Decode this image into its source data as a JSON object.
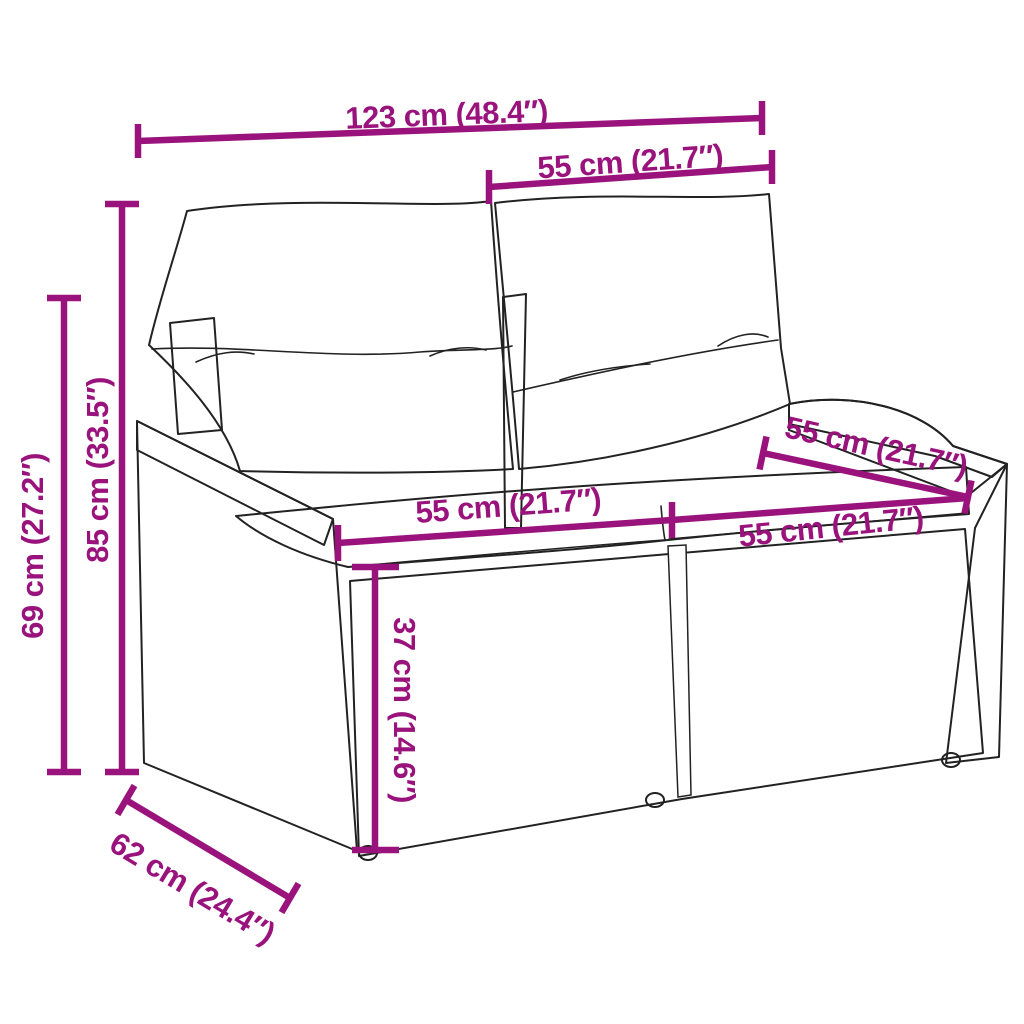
{
  "diagram": {
    "type": "product-dimension-diagram",
    "subject": "poly-rattan 2-seater garden sofa with back and seat cushions",
    "accent_color": "#9a137c",
    "line_art_color": "#222222",
    "background_color": "#ffffff",
    "dimensions": {
      "total_width": "123 cm (48.4″)",
      "backrest_width": "55 cm (21.7″)",
      "total_height": "85 cm (33.5″)",
      "armrest_height": "69 cm (27.2″)",
      "seat_depth": "55 cm (21.7″)",
      "seat_width_left": "55 cm (21.7″)",
      "seat_width_right": "55 cm (21.7″)",
      "seat_height": "37 cm (14.6″)",
      "total_depth": "62 cm (24.4″)"
    }
  }
}
